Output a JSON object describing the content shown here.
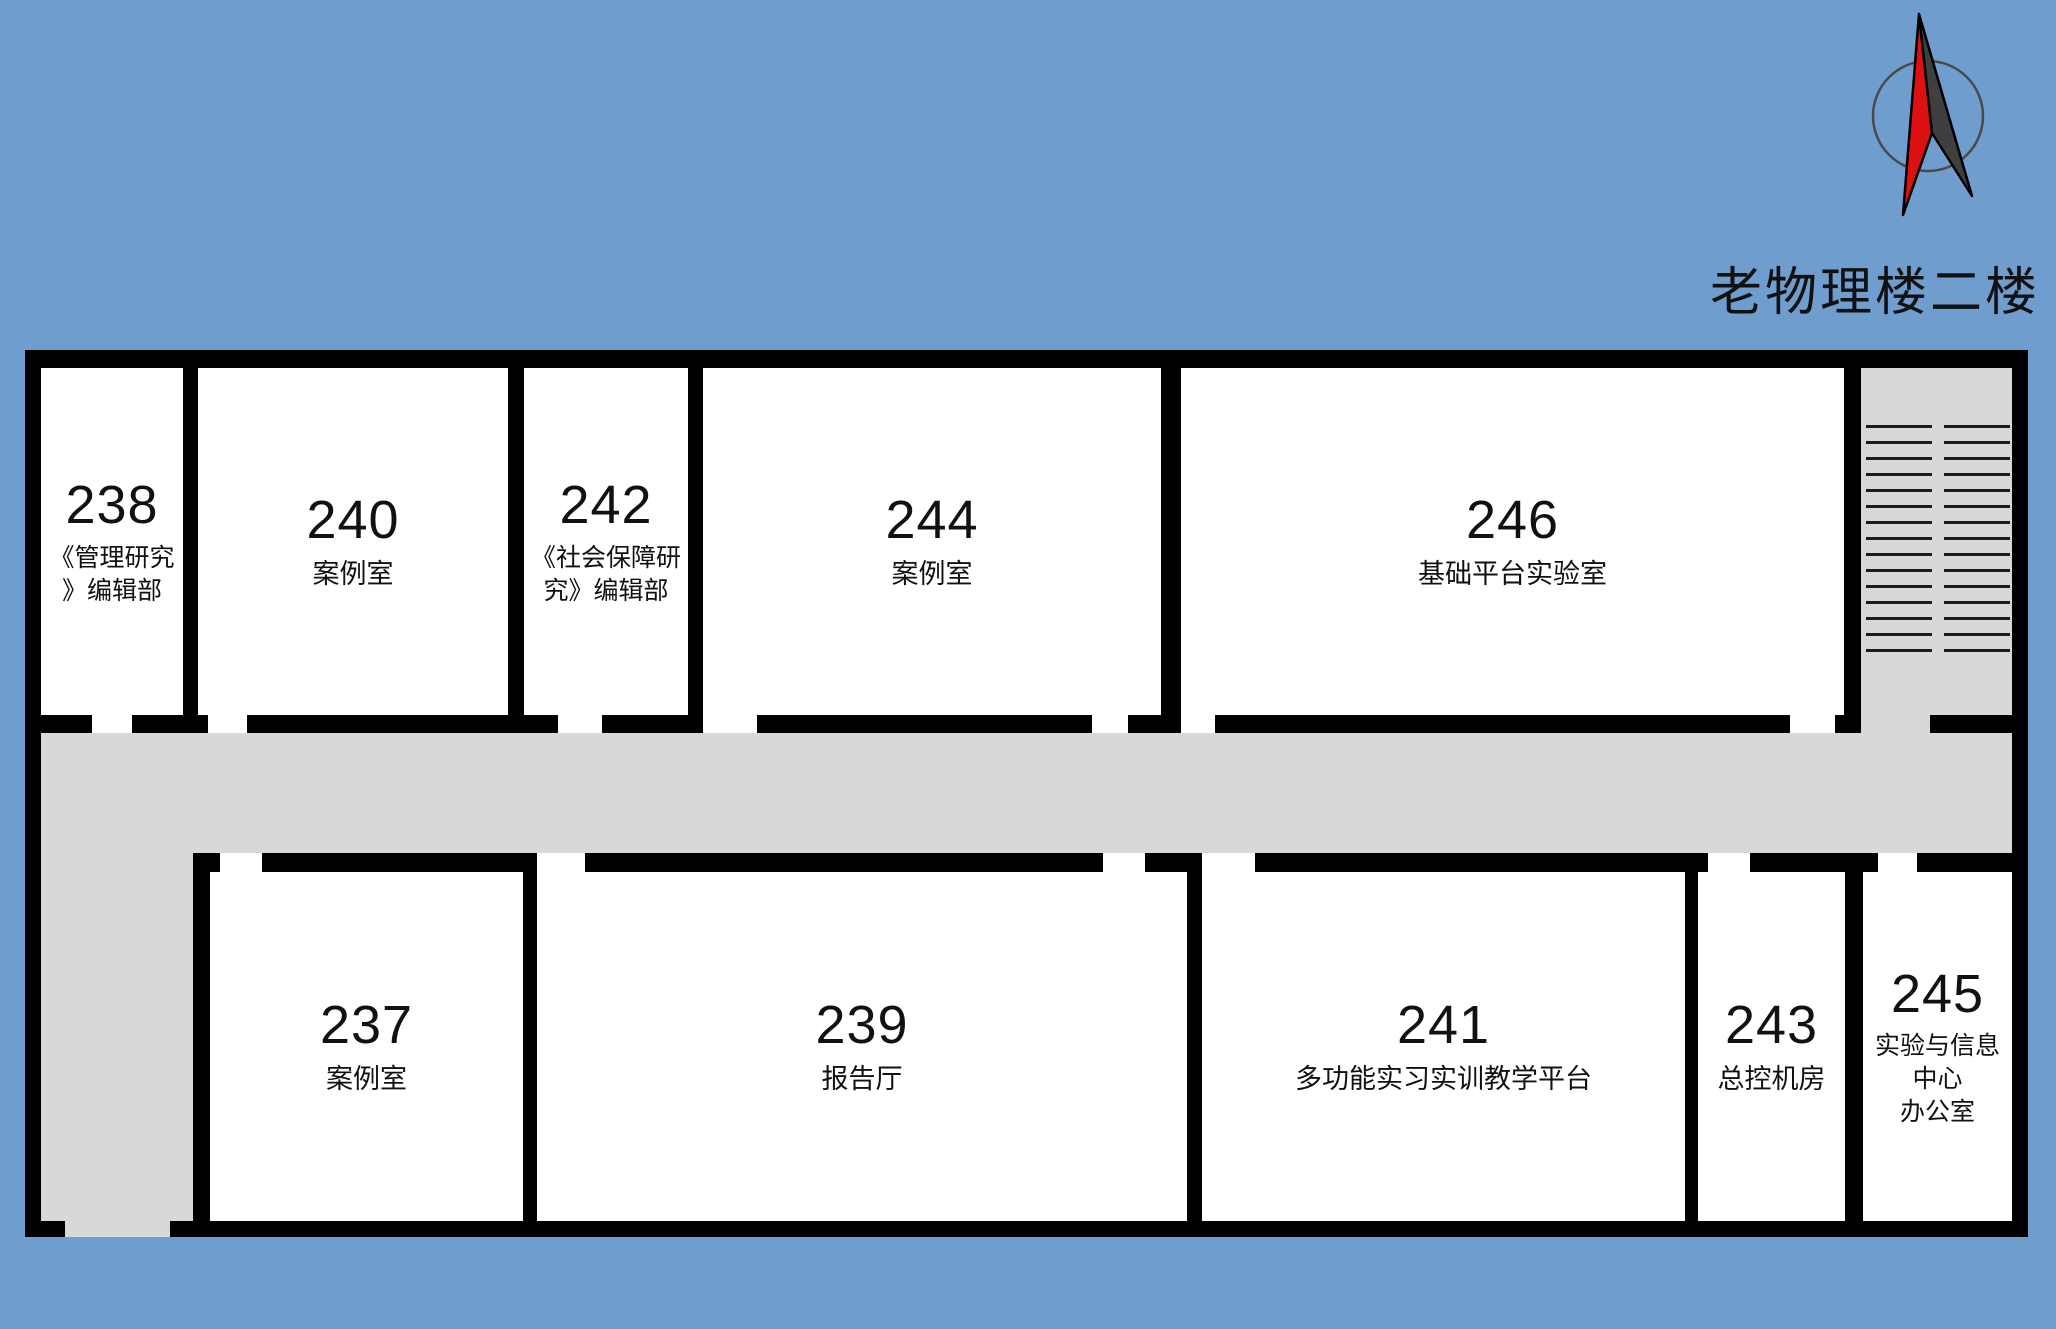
{
  "title": "老物理楼二楼",
  "colors": {
    "background": "#6f9dce",
    "wall": "#000000",
    "corridor": "#d8d8d8",
    "room-fill": "#ffffff",
    "arrow-red": "#dd1111",
    "arrow-dark": "#3f3f3f",
    "tread-line": "#1b1b1b"
  },
  "compass": {
    "icon": "north-arrow-icon"
  },
  "rooms": [
    {
      "number": "238",
      "name_lines": [
        "《管理研究",
        "》编辑部"
      ]
    },
    {
      "number": "240",
      "name_lines": [
        "案例室"
      ]
    },
    {
      "number": "242",
      "name_lines": [
        "《社会保障研",
        "究》编辑部"
      ]
    },
    {
      "number": "244",
      "name_lines": [
        "案例室"
      ]
    },
    {
      "number": "246",
      "name_lines": [
        "基础平台实验室"
      ]
    },
    {
      "number": "237",
      "name_lines": [
        "案例室"
      ]
    },
    {
      "number": "239",
      "name_lines": [
        "报告厅"
      ]
    },
    {
      "number": "241",
      "name_lines": [
        "多功能实习实训教学平台"
      ]
    },
    {
      "number": "243",
      "name_lines": [
        "总控机房"
      ]
    },
    {
      "number": "245",
      "name_lines": [
        "实验与信息",
        "中心",
        "办公室"
      ]
    }
  ]
}
